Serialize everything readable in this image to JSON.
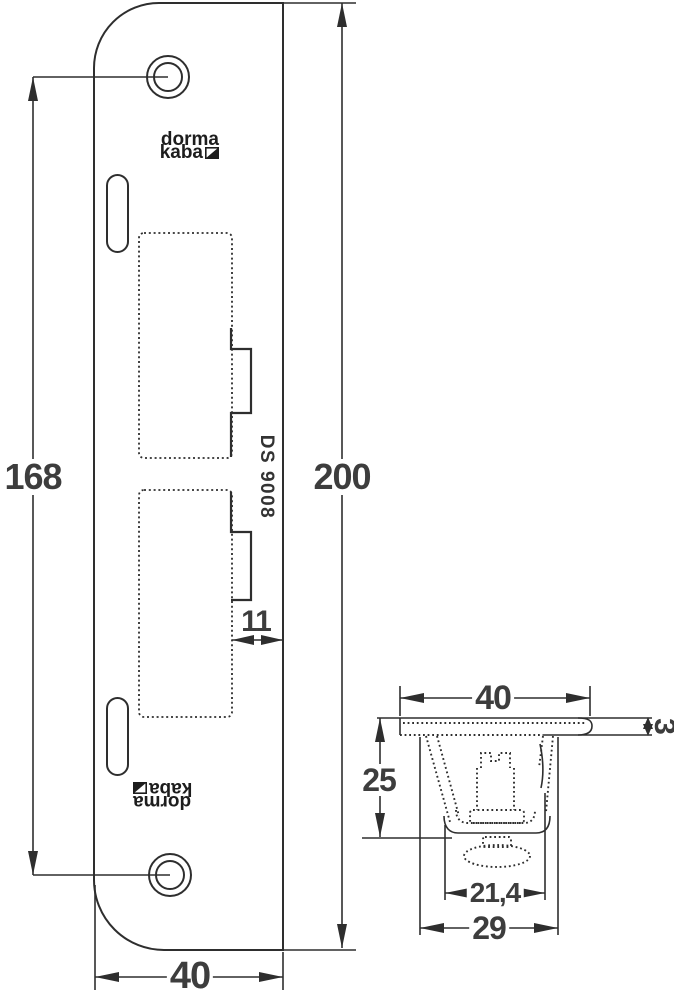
{
  "meta": {
    "title": "Strike plate dimensioned drawing"
  },
  "labels": {
    "brand_line1": "dorma",
    "brand_line2": "kaba",
    "product_code": "DS 9008"
  },
  "front_view": {
    "hole_spacing": "168",
    "total_height": "200",
    "latch_inset": "11",
    "width": "40"
  },
  "side_view": {
    "width": "40",
    "thickness": "3",
    "depth": "25",
    "inner_width": "21,4",
    "outer_width": "29"
  },
  "colors": {
    "line": "#2e2e2e",
    "text": "#3d3d3d",
    "background": "#ffffff"
  }
}
